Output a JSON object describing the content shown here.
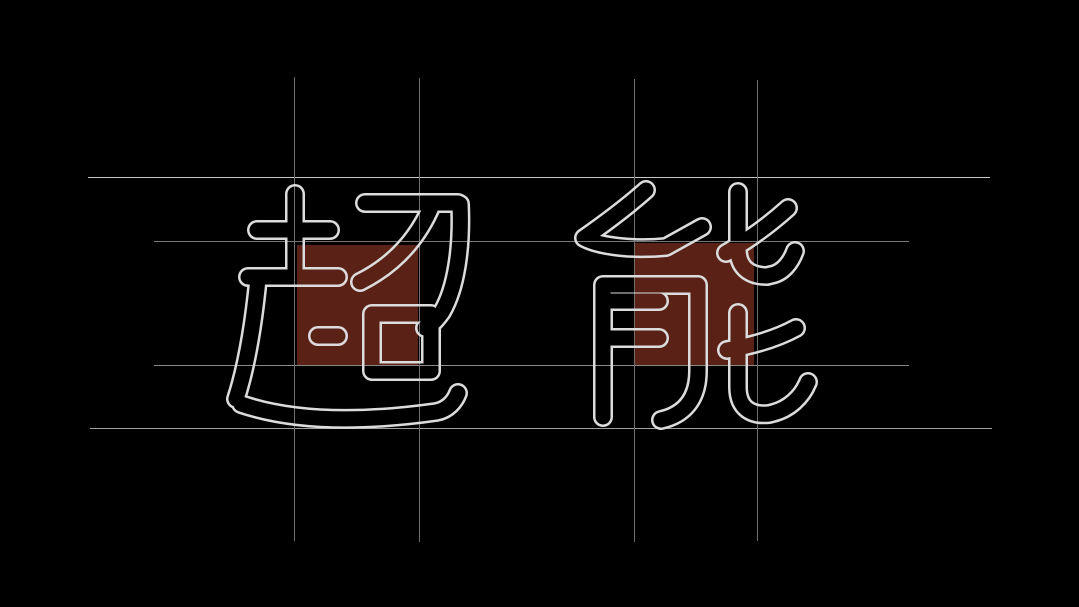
{
  "frame": {
    "kind": "title-design-frame",
    "title": {
      "text": "超能",
      "characters": [
        "超",
        "能"
      ],
      "style": "hollow-outline"
    }
  },
  "colors": {
    "background": "#000000",
    "block_red": "#5a2216",
    "glyph_outline": "#dcdcdc",
    "guide_gray": "#6e6e6e"
  },
  "guides": {
    "horizontal": [
      {
        "y": 177,
        "x1": 88,
        "x2": 990,
        "color": "#c8c8c8"
      },
      {
        "y": 241,
        "x1": 154,
        "x2": 909,
        "color": "#787878"
      },
      {
        "y": 365,
        "x1": 154,
        "x2": 909,
        "color": "#8a8a8a"
      },
      {
        "y": 428,
        "x1": 90,
        "x2": 992,
        "color": "#a0a0a0"
      }
    ],
    "vertical": [
      {
        "x": 294,
        "y1": 77,
        "y2": 541,
        "color": "#6e6e6e"
      },
      {
        "x": 419,
        "y1": 78,
        "y2": 542,
        "color": "#6e6e6e"
      },
      {
        "x": 634,
        "y1": 79,
        "y2": 542,
        "color": "#6e6e6e"
      },
      {
        "x": 757,
        "y1": 80,
        "y2": 541,
        "color": "#6e6e6e"
      }
    ]
  },
  "blocks": [
    {
      "x": 297,
      "y": 245,
      "width": 121,
      "height": 120,
      "color": "#5a2216"
    },
    {
      "x": 634,
      "y": 243,
      "width": 120,
      "height": 122,
      "color": "#5a2216"
    }
  ]
}
